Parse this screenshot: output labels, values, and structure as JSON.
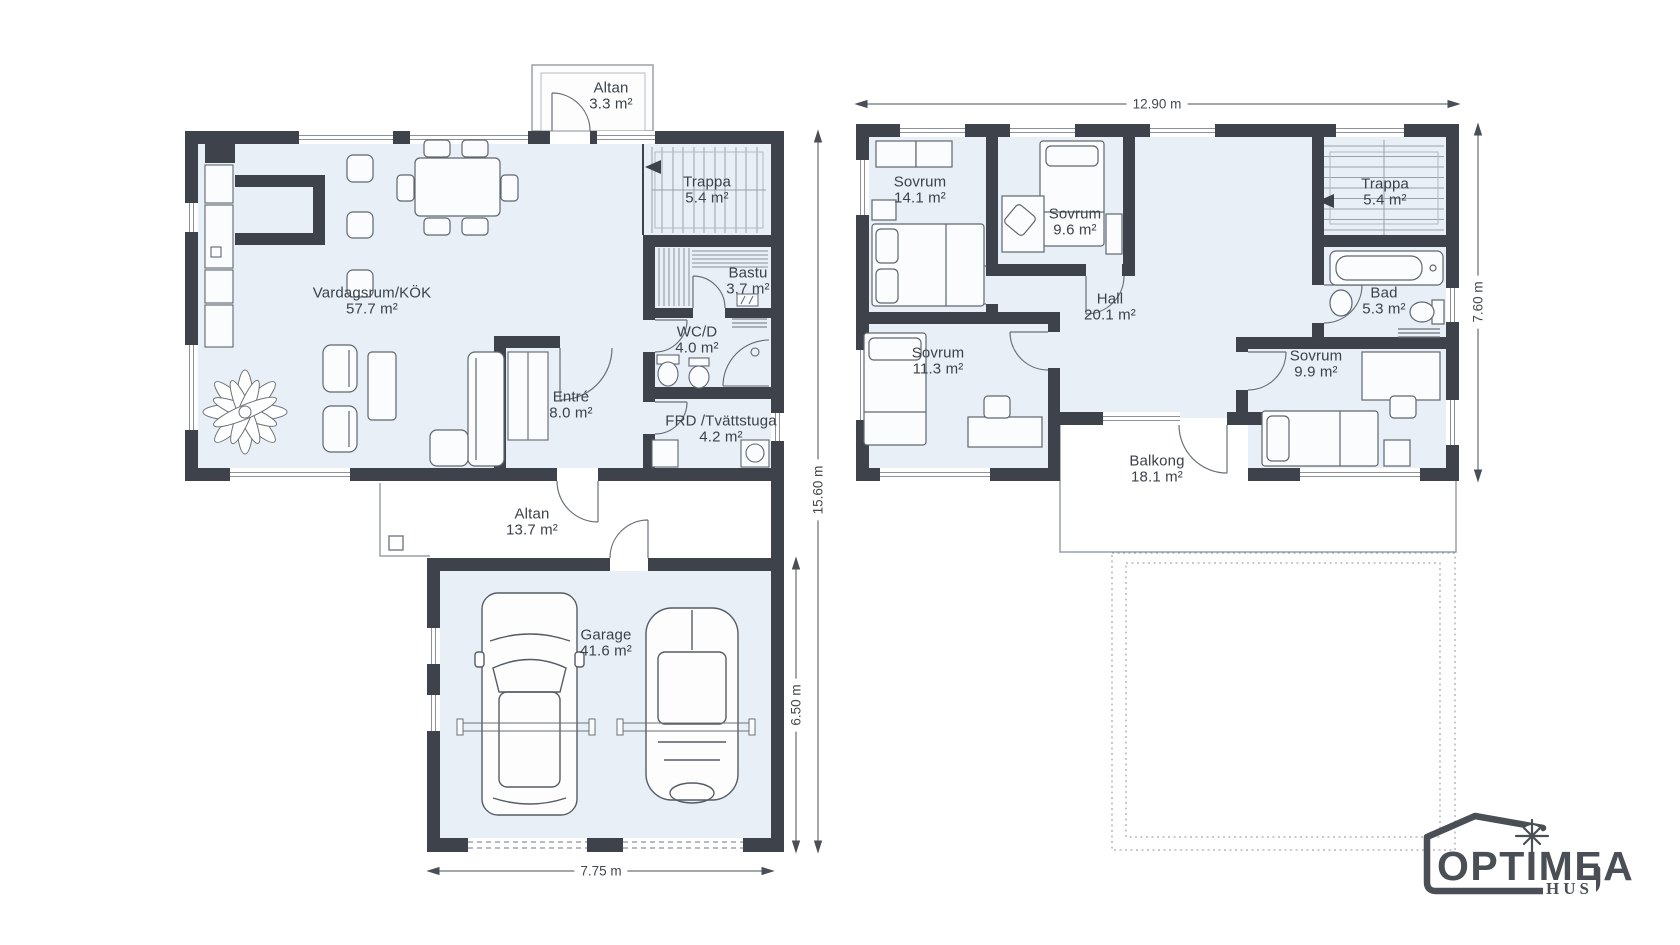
{
  "floor1": {
    "rooms": {
      "altan_top": {
        "name": "Altan",
        "area": "3.3 m²"
      },
      "trappa": {
        "name": "Trappa",
        "area": "5.4 m²"
      },
      "vardagsrum": {
        "name": "Vardagsrum/KÖK",
        "area": "57.7 m²"
      },
      "bastu": {
        "name": "Bastu",
        "area": "3.7 m²"
      },
      "wcd": {
        "name": "WC/D",
        "area": "4.0 m²"
      },
      "entre": {
        "name": "Entré",
        "area": "8.0 m²"
      },
      "frd": {
        "name": "FRD /Tvättstuga",
        "area": "4.2 m²"
      },
      "altan": {
        "name": "Altan",
        "area": "13.7 m²"
      },
      "garage": {
        "name": "Garage",
        "area": "41.6 m²"
      }
    },
    "dimensions": {
      "bottom": "7.75 m",
      "right_total": "15.60 m",
      "right_garage": "6.50 m"
    }
  },
  "floor2": {
    "rooms": {
      "sovrum_14": {
        "name": "Sovrum",
        "area": "14.1 m²"
      },
      "sovrum_96": {
        "name": "Sovrum",
        "area": "9.6 m²"
      },
      "trappa": {
        "name": "Trappa",
        "area": "5.4 m²"
      },
      "bad": {
        "name": "Bad",
        "area": "5.3 m²"
      },
      "hall": {
        "name": "Hall",
        "area": "20.1 m²"
      },
      "sovrum_113": {
        "name": "Sovrum",
        "area": "11.3 m²"
      },
      "sovrum_99": {
        "name": "Sovrum",
        "area": "9.9 m²"
      },
      "balkong": {
        "name": "Balkong",
        "area": "18.1 m²"
      }
    },
    "dimensions": {
      "top": "12.90 m",
      "right": "7.60 m"
    }
  },
  "logo": {
    "brand": "OPTIMEA",
    "sub": "HUS"
  },
  "colors": {
    "wall": "#3e434b",
    "floor": "#e9eff7",
    "accent": "#4a4e55",
    "furniture_line": "#5f6670"
  }
}
